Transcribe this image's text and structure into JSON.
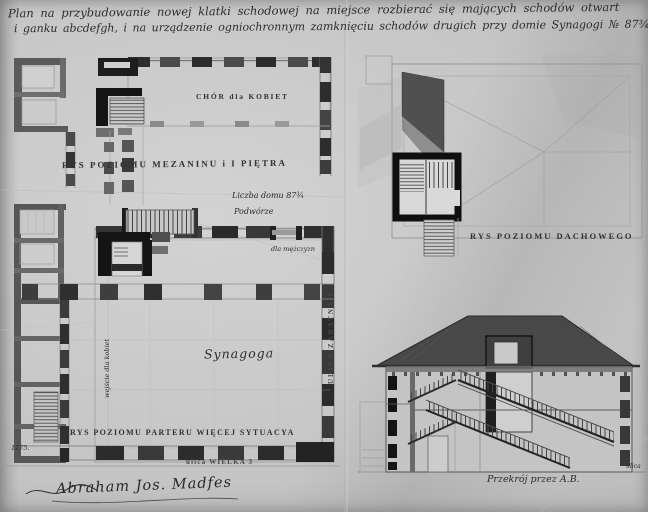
{
  "document": {
    "title_line1": "Plan na przybudowanie nowej klatki schodowej na miejsce rozbierać się mających schodów otwart",
    "title_line2": "i ganku abcdefgh, i na urządzenie ogniochronnym zamknięciu schodów drugich przy domie Synagogi № 87¾.",
    "signature": "Abraham Jos. Madfes",
    "archive_number": "1275."
  },
  "drawings": {
    "mezzanine_plan": {
      "caption": "RYS POZIOMU MEZANINU i I PIĘTRA",
      "room_label": "CHÓR dla KOBIET"
    },
    "ground_plan": {
      "caption": "RYS POZIOMU PARTERU WIĘCEJ SYTUACYA",
      "hall_label": "Synagoga",
      "courtyard_label": "Podwórze",
      "house_number_label": "Liczba domu 87¾",
      "mens_entrance_label": "dla mężczyzn",
      "womens_entrance_label": "wejście dla kobiet",
      "street_right_label": "ULICA ZARATNA 1",
      "street_bottom_label": "ulica WIELKA 3"
    },
    "roof_plan": {
      "caption": "RYS POZIOMU DACHOWEGO"
    },
    "section": {
      "caption": "Przekrój przez A.B.",
      "edge_note": "ulica"
    }
  },
  "colors": {
    "paper": "#c7c7c7",
    "ink": "#1c1c1c",
    "pencil": "#9a9a9a",
    "wall": "#2b2b2b"
  }
}
